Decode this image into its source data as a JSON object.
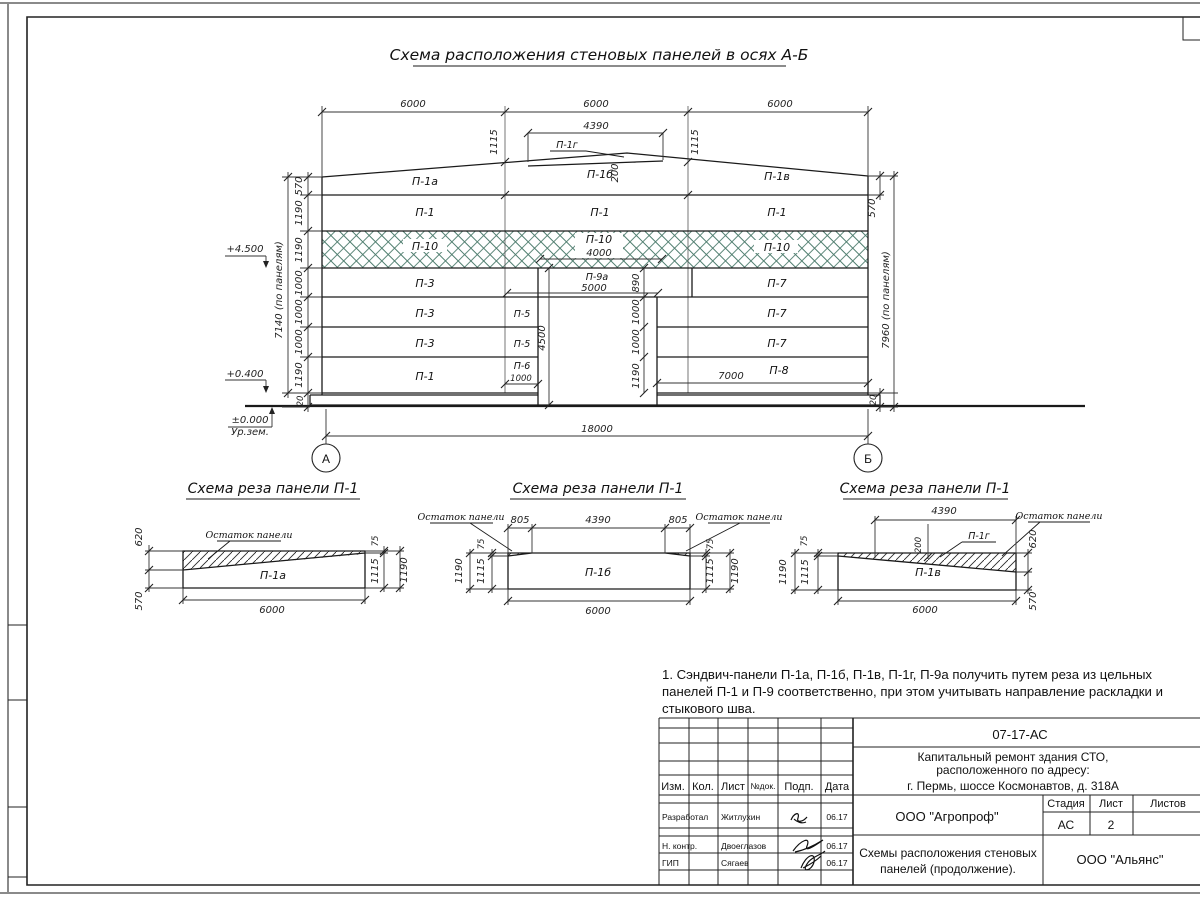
{
  "colors": {
    "hatch_green": "#4e7d6e",
    "line": "#1a1a1a"
  },
  "sheet": {
    "title": "Схема расположения стеновых панелей в осях А-Б"
  },
  "elev": {
    "top_dims": [
      "6000",
      "6000",
      "6000"
    ],
    "dim_4390": "4390",
    "dim_200": "200",
    "dim_1115_left": "1115",
    "dim_1115_right": "1115",
    "label_p1g": "П-1г",
    "row1": [
      "П-1а",
      "П-1б",
      "П-1в"
    ],
    "row2": [
      "П-1",
      "П-1",
      "П-1"
    ],
    "row3": [
      "П-10",
      "П-10",
      "П-10"
    ],
    "dim_4000": "4000",
    "row4": [
      "П-3",
      "П-9а",
      "П-7"
    ],
    "dim_5000": "5000",
    "row5": [
      "П-3",
      "П-5",
      "П-7"
    ],
    "row6": [
      "П-3",
      "П-5",
      "П-7"
    ],
    "row7": [
      "П-1",
      "П-6",
      "П-8"
    ],
    "dim_1000_p6": "1000",
    "dim_7000": "7000",
    "left_chain": [
      "570",
      "1190",
      "1190",
      "1000",
      "1000",
      "1000",
      "1190",
      "20"
    ],
    "left_total": "7140 (по панелям)",
    "right_570": "570",
    "right_total": "7960 (по панелям)",
    "right_20": "20",
    "door_height": "4500",
    "door_chain": [
      "890",
      "1000",
      "1000",
      "1190"
    ],
    "dim_18000": "18000",
    "level_top": "+4.500",
    "level_mid": "+0.400",
    "level_zero": "±0.000",
    "ground_label": "Ур.зем.",
    "axis_left": "А",
    "axis_right": "Б"
  },
  "cut1": {
    "title": "Схема реза панели П-1",
    "remainder": "Остаток панели",
    "panel": "П-1а",
    "dim620": "620",
    "dim570": "570",
    "dim75": "75",
    "dim1115": "1115",
    "dim1190": "1190",
    "dim6000": "6000"
  },
  "cut2": {
    "title": "Схема реза панели П-1",
    "remainder_left": "Остаток панели",
    "remainder_right": "Остаток панели",
    "panel": "П-1б",
    "dim805_left": "805",
    "dim4390": "4390",
    "dim805_right": "805",
    "l75": "75",
    "l1115": "1115",
    "l1190": "1190",
    "r75": "75",
    "r1115": "1115",
    "r1190": "1190",
    "dim6000": "6000"
  },
  "cut3": {
    "title": "Схема реза панели П-1",
    "remainder": "Остаток панели",
    "panel_cut": "П-1г",
    "panel": "П-1в",
    "dim4390": "4390",
    "dim200": "200",
    "dim620": "620",
    "dim570": "570",
    "l75": "75",
    "l1115": "1115",
    "l1190": "1190",
    "dim6000": "6000"
  },
  "note": "1. Сэндвич-панели П-1а, П-1б, П-1в, П-1г, П-9а получить путем реза из цельных панелей П-1 и П-9 соответственно, при этом учитывать направление раскладки и стыкового шва.",
  "tb": {
    "doc_no": "07-17-АС",
    "project1": "Капитальный ремонт здания СТО,",
    "project2": "расположенного по адресу:",
    "project3": "г. Пермь, шоссе Космонавтов, д. 318А",
    "h_izm": "Изм.",
    "h_kol": "Кол.",
    "h_list": "Лист",
    "h_ndok": "№док.",
    "h_podp": "Подп.",
    "h_data": "Дата",
    "r1_role": "Разработал",
    "r1_name": "Житлухин",
    "r1_date": "06.17",
    "r2_role": "Н. контр.",
    "r2_name": "Двоеглазов",
    "r2_date": "06.17",
    "r3_role": "ГИП",
    "r3_name": "Сягаев",
    "r3_date": "06.17",
    "org": "ООО \"Агропроф\"",
    "h_stage": "Стадия",
    "h_sheet": "Лист",
    "h_sheets": "Листов",
    "stage": "АС",
    "sheet": "2",
    "sheet_title1": "Схемы расположения стеновых",
    "sheet_title2": "панелей (продолжение).",
    "org2": "ООО \"Альянс\""
  }
}
